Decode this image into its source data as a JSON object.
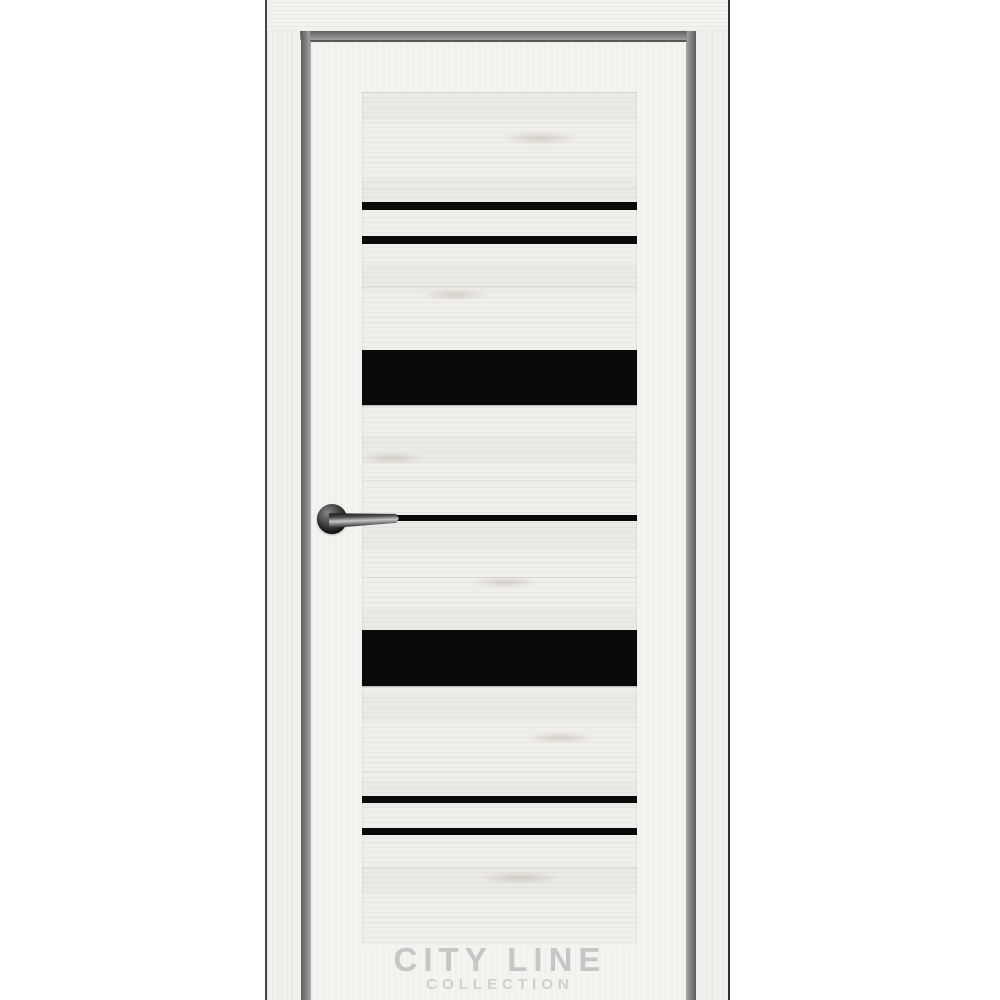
{
  "image": {
    "description": "Product photo of an interior door with light whitewashed oak texture, black glass stripe inserts and a dark lever handle",
    "background_color": "#ffffff"
  },
  "door": {
    "frame": {
      "wood_color": "#f2f1ee",
      "outer_edge_color": "#3a3a3a",
      "reveal_gap_color": "#7d7d7d"
    },
    "leaf": {
      "wood_color": "#f4f3f0",
      "panel_color": "#f1efec",
      "top_edge_color": "#575757"
    },
    "glass": {
      "color": "#0a0a0a",
      "inserts": [
        {
          "kind": "thin-stripe",
          "x": 362,
          "y": 202,
          "width": 275,
          "height": 8
        },
        {
          "kind": "thin-stripe",
          "x": 362,
          "y": 236,
          "width": 275,
          "height": 8
        },
        {
          "kind": "wide-panel",
          "x": 362,
          "y": 350,
          "width": 275,
          "height": 55
        },
        {
          "kind": "thin-stripe",
          "x": 362,
          "y": 515,
          "width": 275,
          "height": 6
        },
        {
          "kind": "wide-panel",
          "x": 362,
          "y": 630,
          "width": 275,
          "height": 56
        },
        {
          "kind": "thin-stripe",
          "x": 362,
          "y": 796,
          "width": 275,
          "height": 7
        },
        {
          "kind": "thin-stripe",
          "x": 362,
          "y": 828,
          "width": 275,
          "height": 7
        }
      ]
    },
    "handle": {
      "rosette_color": "#1c1c1c",
      "lever_highlight_color": "#c8c8c8"
    },
    "wood_knots": [
      {
        "x": 540,
        "y": 138,
        "width": 80,
        "height": 14
      },
      {
        "x": 455,
        "y": 295,
        "width": 70,
        "height": 12
      },
      {
        "x": 392,
        "y": 458,
        "width": 66,
        "height": 12
      },
      {
        "x": 505,
        "y": 582,
        "width": 72,
        "height": 12
      },
      {
        "x": 560,
        "y": 738,
        "width": 70,
        "height": 12
      },
      {
        "x": 520,
        "y": 878,
        "width": 84,
        "height": 14
      }
    ]
  },
  "watermark": {
    "line1": "CITY LINE",
    "line2": "COLLECTION",
    "line1_color": "#c6c6c6",
    "line2_color": "#cfcfcf"
  }
}
